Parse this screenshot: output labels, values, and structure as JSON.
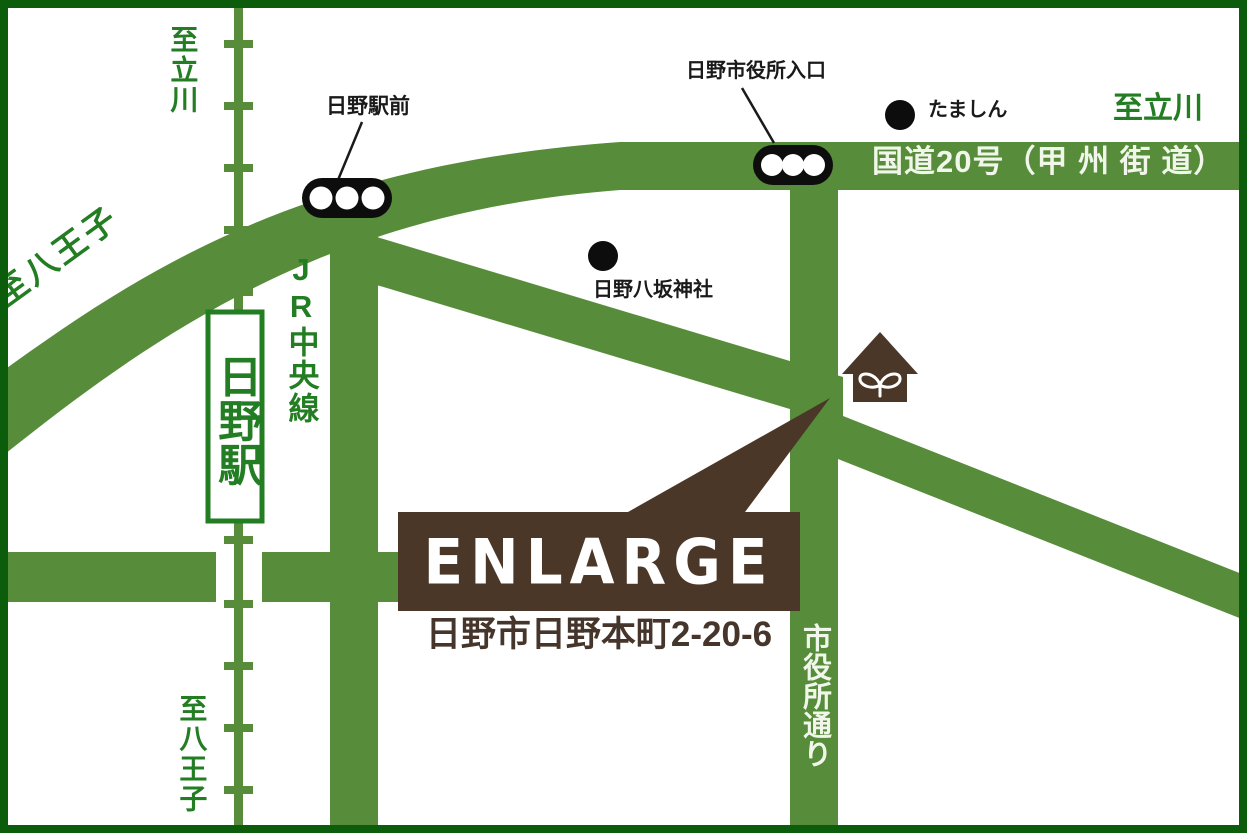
{
  "destination": {
    "logo": "ENLARGE",
    "address": "日野市日野本町2-20-6"
  },
  "roads": {
    "route20": "国道20号（甲 州 街 道）",
    "shiyakusho_dori": "市役所通り"
  },
  "railway": {
    "line": "JR中央線",
    "station": "日野駅"
  },
  "directions": {
    "tachikawa_nw": "至立川",
    "tachikawa_ne": "至立川",
    "hachioji_w": "至八王子",
    "hachioji_s": "至八王子"
  },
  "signals": [
    {
      "label": "日野駅前"
    },
    {
      "label": "日野市役所入口"
    }
  ],
  "pois": [
    {
      "label": "日野八坂神社"
    },
    {
      "label": "たましん"
    }
  ],
  "colors": {
    "road_green": "#578c3a",
    "text_green": "#237d23",
    "frame_green": "#0b5c0b",
    "brown": "#4b3728",
    "signal_black": "#0d0d0d",
    "road_text_white": "#f1f6ea"
  }
}
